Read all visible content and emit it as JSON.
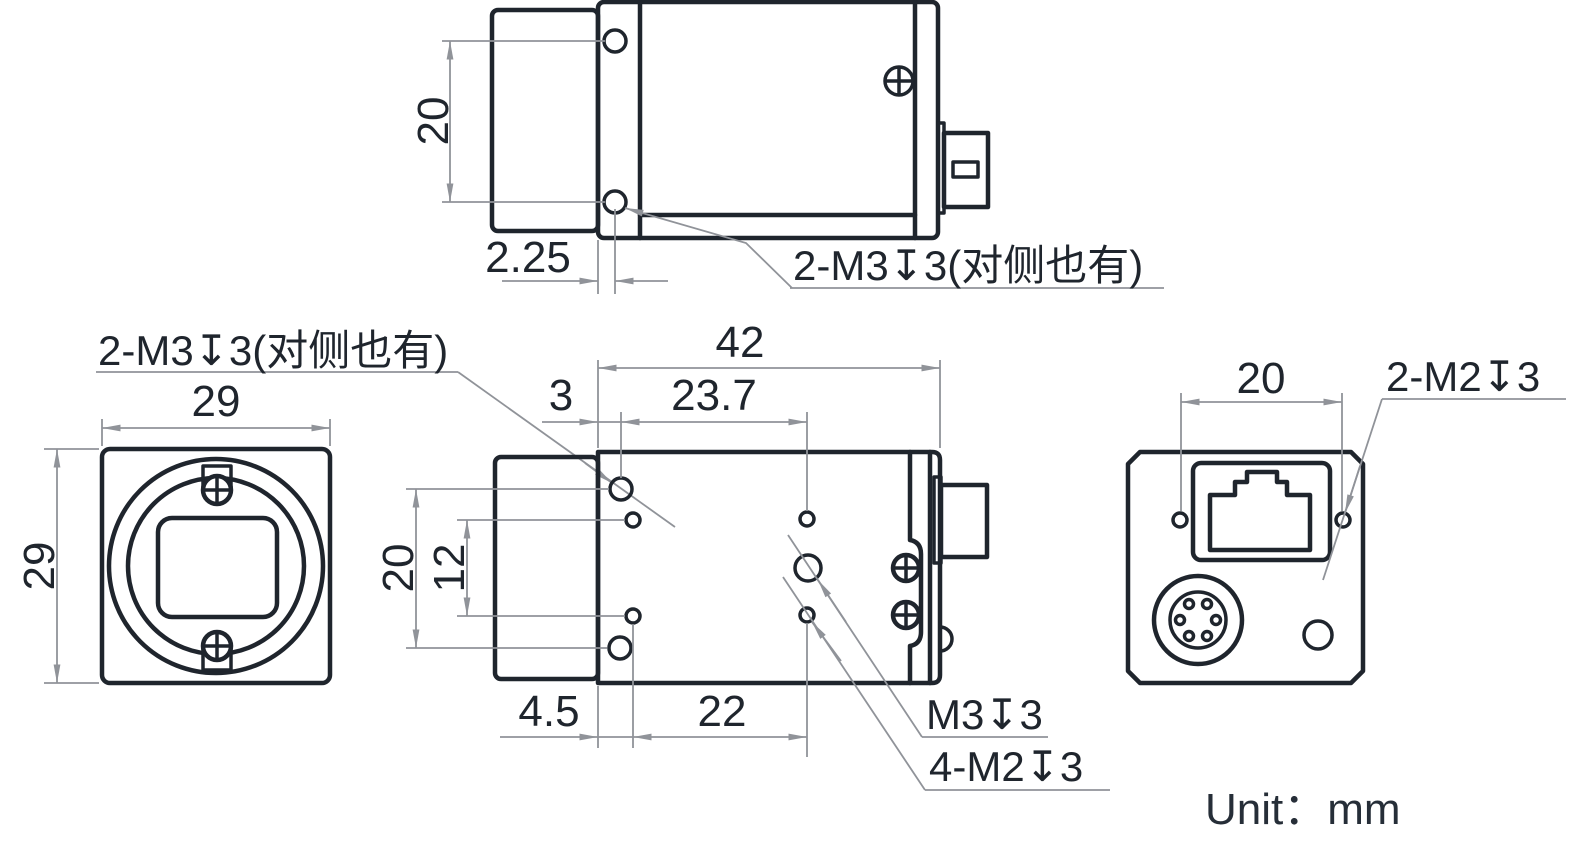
{
  "drawing": {
    "unit_label": "Unit：mm",
    "colors": {
      "outline": "#1f252d",
      "dimension_lines": "#909399",
      "background": "#ffffff"
    },
    "labels": {
      "top_side_thread": "2-M3↧3(对侧也有)",
      "front_side_thread": "2-M3↧3(对侧也有)",
      "center_thread": "M3↧3",
      "m2_threads": "4-M2↧3",
      "rear_threads": "2-M2↧3"
    },
    "dimensions": {
      "top_view": {
        "hole_spacing": "20",
        "hole_offset": "2.25"
      },
      "front_view": {
        "width": "29",
        "height": "29"
      },
      "side_view": {
        "length": "42",
        "front_offset": "3",
        "center_offset": "23.7",
        "hole_spacing": "20",
        "m2_spacing_vertical": "12",
        "m2_offset": "4.5",
        "m2_spacing_horizontal": "22"
      },
      "rear_view": {
        "hole_spacing": "20"
      }
    }
  }
}
